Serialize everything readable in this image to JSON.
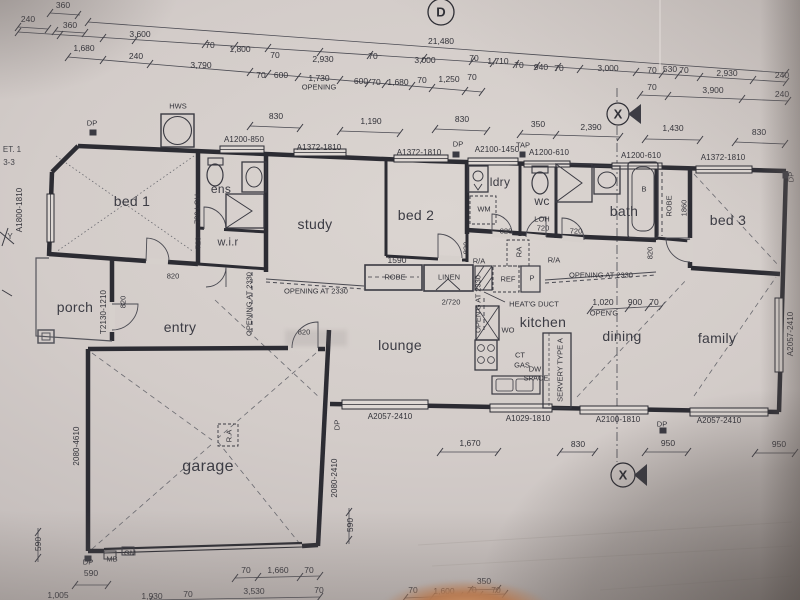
{
  "sheet": {
    "kind": "floor plan photograph",
    "paper_color": "#d3ccc9",
    "ink_color": "#33333a"
  },
  "labels": {
    "rooms": [
      {
        "t": "bed 1",
        "x": 132,
        "y": 201
      },
      {
        "t": "ens",
        "x": 221,
        "y": 189,
        "s": 12
      },
      {
        "t": "w.i.r",
        "x": 228,
        "y": 243,
        "s": 11
      },
      {
        "t": "study",
        "x": 315,
        "y": 224
      },
      {
        "t": "bed 2",
        "x": 416,
        "y": 215
      },
      {
        "t": "ldry",
        "x": 500,
        "y": 182,
        "s": 12
      },
      {
        "t": "wc",
        "x": 542,
        "y": 201,
        "s": 12
      },
      {
        "t": "bath",
        "x": 624,
        "y": 211
      },
      {
        "t": "bed 3",
        "x": 728,
        "y": 220
      },
      {
        "t": "porch",
        "x": 75,
        "y": 307
      },
      {
        "t": "entry",
        "x": 180,
        "y": 327
      },
      {
        "t": "lounge",
        "x": 400,
        "y": 345
      },
      {
        "t": "kitchen",
        "x": 543,
        "y": 322
      },
      {
        "t": "dining",
        "x": 622,
        "y": 336
      },
      {
        "t": "family",
        "x": 717,
        "y": 338
      },
      {
        "t": "garage",
        "x": 208,
        "y": 467,
        "s": 16
      }
    ],
    "windows_doors": [
      {
        "t": "A1200-850",
        "x": 244,
        "y": 140
      },
      {
        "t": "A1372-1810",
        "x": 319,
        "y": 148
      },
      {
        "t": "A1372-1810",
        "x": 419,
        "y": 153
      },
      {
        "t": "A2100-1450",
        "x": 497,
        "y": 150
      },
      {
        "t": "A1200-610",
        "x": 549,
        "y": 153
      },
      {
        "t": "A1200-610",
        "x": 641,
        "y": 156
      },
      {
        "t": "A1372-1810",
        "x": 723,
        "y": 158
      },
      {
        "t": "A2057-2410",
        "x": 390,
        "y": 417
      },
      {
        "t": "A1029-1810",
        "x": 528,
        "y": 419
      },
      {
        "t": "A2100-1810",
        "x": 618,
        "y": 420
      },
      {
        "t": "A2057-2410",
        "x": 719,
        "y": 421
      },
      {
        "t": "A1800-1810",
        "x": 20,
        "y": 210,
        "r": -90
      },
      {
        "t": "A2057-2410",
        "x": 791,
        "y": 334,
        "r": -90
      },
      {
        "t": "2080-4610",
        "x": 77,
        "y": 446,
        "r": -90
      },
      {
        "t": "2080-2410",
        "x": 335,
        "y": 478,
        "r": -90
      },
      {
        "t": "T2130-1210",
        "x": 104,
        "y": 312,
        "r": -90
      }
    ],
    "dimensions": [
      {
        "t": "360",
        "x": 63,
        "y": 5
      },
      {
        "t": "240",
        "x": 28,
        "y": 19
      },
      {
        "t": "360",
        "x": 70,
        "y": 25
      },
      {
        "t": "3,600",
        "x": 140,
        "y": 34
      },
      {
        "t": "1,680",
        "x": 84,
        "y": 48
      },
      {
        "t": "240",
        "x": 136,
        "y": 56
      },
      {
        "t": "70",
        "x": 210,
        "y": 45
      },
      {
        "t": "1,800",
        "x": 240,
        "y": 49
      },
      {
        "t": "3,790",
        "x": 201,
        "y": 65
      },
      {
        "t": "70",
        "x": 275,
        "y": 55
      },
      {
        "t": "2,930",
        "x": 323,
        "y": 59
      },
      {
        "t": "70",
        "x": 373,
        "y": 56
      },
      {
        "t": "21,480",
        "x": 441,
        "y": 41
      },
      {
        "t": "3,000",
        "x": 425,
        "y": 60
      },
      {
        "t": "70",
        "x": 474,
        "y": 58
      },
      {
        "t": "1,710",
        "x": 498,
        "y": 61
      },
      {
        "t": "70",
        "x": 519,
        "y": 65
      },
      {
        "t": "940",
        "x": 541,
        "y": 67
      },
      {
        "t": "70",
        "x": 559,
        "y": 68
      },
      {
        "t": "3,000",
        "x": 608,
        "y": 68
      },
      {
        "t": "70",
        "x": 652,
        "y": 70
      },
      {
        "t": "530",
        "x": 670,
        "y": 69
      },
      {
        "t": "70",
        "x": 684,
        "y": 70
      },
      {
        "t": "2,930",
        "x": 727,
        "y": 73
      },
      {
        "t": "240",
        "x": 782,
        "y": 75
      },
      {
        "t": "70",
        "x": 261,
        "y": 75
      },
      {
        "t": "600",
        "x": 281,
        "y": 75
      },
      {
        "t": "1,730",
        "x": 319,
        "y": 78
      },
      {
        "t": "600",
        "x": 361,
        "y": 81
      },
      {
        "t": "70",
        "x": 376,
        "y": 82
      },
      {
        "t": "1,680",
        "x": 398,
        "y": 82
      },
      {
        "t": "70",
        "x": 422,
        "y": 80
      },
      {
        "t": "1,250",
        "x": 449,
        "y": 79
      },
      {
        "t": "70",
        "x": 472,
        "y": 77
      },
      {
        "t": "70",
        "x": 652,
        "y": 87
      },
      {
        "t": "3,900",
        "x": 713,
        "y": 90
      },
      {
        "t": "240",
        "x": 782,
        "y": 94
      },
      {
        "t": "830",
        "x": 276,
        "y": 116
      },
      {
        "t": "1,190",
        "x": 371,
        "y": 121
      },
      {
        "t": "830",
        "x": 462,
        "y": 119
      },
      {
        "t": "350",
        "x": 538,
        "y": 124
      },
      {
        "t": "2,390",
        "x": 591,
        "y": 127
      },
      {
        "t": "1,430",
        "x": 673,
        "y": 128
      },
      {
        "t": "830",
        "x": 759,
        "y": 132
      },
      {
        "t": "1590",
        "x": 397,
        "y": 260
      },
      {
        "t": "1,020",
        "x": 603,
        "y": 302
      },
      {
        "t": "900",
        "x": 635,
        "y": 302
      },
      {
        "t": "70",
        "x": 654,
        "y": 302
      },
      {
        "t": "1,670",
        "x": 470,
        "y": 443
      },
      {
        "t": "830",
        "x": 578,
        "y": 444
      },
      {
        "t": "950",
        "x": 668,
        "y": 443
      },
      {
        "t": "950",
        "x": 779,
        "y": 444
      },
      {
        "t": "590",
        "x": 38,
        "y": 544,
        "r": -90
      },
      {
        "t": "590",
        "x": 350,
        "y": 525,
        "r": -90
      },
      {
        "t": "590",
        "x": 91,
        "y": 573
      },
      {
        "t": "70",
        "x": 246,
        "y": 570
      },
      {
        "t": "1,660",
        "x": 278,
        "y": 570
      },
      {
        "t": "70",
        "x": 309,
        "y": 570
      },
      {
        "t": "3,530",
        "x": 254,
        "y": 591
      },
      {
        "t": "70",
        "x": 319,
        "y": 590
      },
      {
        "t": "1,005",
        "x": 58,
        "y": 595
      },
      {
        "t": "1,930",
        "x": 152,
        "y": 596
      },
      {
        "t": "70",
        "x": 188,
        "y": 594
      },
      {
        "t": "350",
        "x": 484,
        "y": 581
      },
      {
        "t": "70",
        "x": 413,
        "y": 590
      },
      {
        "t": "1,600",
        "x": 444,
        "y": 591
      },
      {
        "t": "70",
        "x": 472,
        "y": 590
      },
      {
        "t": "70",
        "x": 496,
        "y": 590
      }
    ],
    "annotations": [
      {
        "t": "OPENING",
        "x": 319,
        "y": 87
      },
      {
        "t": "OPEN'G",
        "x": 604,
        "y": 313
      },
      {
        "t": "DP",
        "x": 92,
        "y": 123
      },
      {
        "t": "HWS",
        "x": 178,
        "y": 106
      },
      {
        "t": "DP",
        "x": 458,
        "y": 144
      },
      {
        "t": "TAP",
        "x": 523,
        "y": 145
      },
      {
        "t": "DP",
        "x": 791,
        "y": 177,
        "r": -90
      },
      {
        "t": "DP",
        "x": 337,
        "y": 425,
        "r": -90
      },
      {
        "t": "DP",
        "x": 662,
        "y": 424
      },
      {
        "t": "DP",
        "x": 88,
        "y": 562
      },
      {
        "t": "MB",
        "x": 112,
        "y": 559
      },
      {
        "t": "GM",
        "x": 130,
        "y": 553
      },
      {
        "t": "WM",
        "x": 484,
        "y": 209
      },
      {
        "t": "WO",
        "x": 508,
        "y": 330
      },
      {
        "t": "REF",
        "x": 508,
        "y": 279
      },
      {
        "t": "P",
        "x": 532,
        "y": 278
      },
      {
        "t": "R/A",
        "x": 479,
        "y": 261
      },
      {
        "t": "R/A",
        "x": 554,
        "y": 260
      },
      {
        "t": "RA",
        "x": 519,
        "y": 252,
        "r": -90
      },
      {
        "t": "R.A",
        "x": 229,
        "y": 436,
        "r": -90
      },
      {
        "t": "ROBE",
        "x": 669,
        "y": 206,
        "r": -90
      },
      {
        "t": "1860",
        "x": 684,
        "y": 208,
        "r": -90
      },
      {
        "t": "B",
        "x": 644,
        "y": 189
      },
      {
        "t": "LINEN",
        "x": 449,
        "y": 277
      },
      {
        "t": "ROBE",
        "x": 395,
        "y": 277
      },
      {
        "t": "CT",
        "x": 520,
        "y": 355
      },
      {
        "t": "GAS",
        "x": 522,
        "y": 365
      },
      {
        "t": "DW",
        "x": 535,
        "y": 369
      },
      {
        "t": "SPACE",
        "x": 536,
        "y": 378
      },
      {
        "t": "SERVERY TYPE A",
        "x": 560,
        "y": 370,
        "r": -90
      },
      {
        "t": "HEAT'G DUCT",
        "x": 534,
        "y": 304
      },
      {
        "t": "OPENING AT 2330",
        "x": 316,
        "y": 291
      },
      {
        "t": "OPENING AT 2330",
        "x": 601,
        "y": 275
      },
      {
        "t": "OPENING AT 2330",
        "x": 249,
        "y": 304,
        "r": -90
      },
      {
        "t": "OPEN'G AT 2330",
        "x": 478,
        "y": 304,
        "r": -90
      },
      {
        "t": "2/720",
        "x": 451,
        "y": 302
      },
      {
        "t": "LOH",
        "x": 542,
        "y": 219
      },
      {
        "t": "720",
        "x": 543,
        "y": 228
      },
      {
        "t": "720",
        "x": 576,
        "y": 231
      },
      {
        "t": "820",
        "x": 506,
        "y": 231
      },
      {
        "t": "820",
        "x": 173,
        "y": 276
      },
      {
        "t": "820",
        "x": 304,
        "y": 332
      },
      {
        "t": "820",
        "x": 123,
        "y": 302,
        "r": -90
      },
      {
        "t": "720 LOH",
        "x": 197,
        "y": 209,
        "r": -90
      },
      {
        "t": "720",
        "x": 198,
        "y": 243,
        "r": -90
      },
      {
        "t": "820",
        "x": 466,
        "y": 248,
        "r": -90
      },
      {
        "t": "820",
        "x": 650,
        "y": 253,
        "r": -90
      }
    ],
    "markers": [
      {
        "t": "D",
        "x": 441,
        "y": 12
      },
      {
        "t": "X",
        "x": 618,
        "y": 114
      },
      {
        "t": "X",
        "x": 623,
        "y": 475
      }
    ],
    "edge_refs": [
      {
        "t": "ET. 1",
        "x": 12,
        "y": 150
      },
      {
        "t": "3-3",
        "x": 9,
        "y": 163
      },
      {
        "t": "Y",
        "x": 10,
        "y": 237
      }
    ]
  }
}
